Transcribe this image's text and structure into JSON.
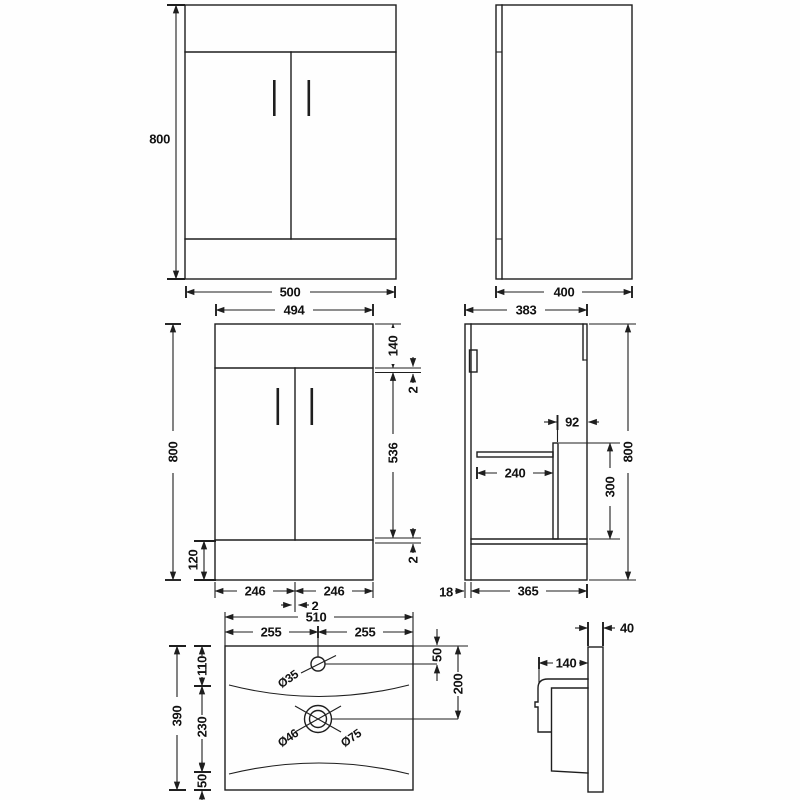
{
  "front_elevation": {
    "height": "800",
    "width": "500"
  },
  "side_elevation": {
    "depth": "400"
  },
  "front_detail": {
    "width": "494",
    "height": "800",
    "top_panel": "140",
    "top_gap": "2",
    "door_height": "536",
    "bottom_gap": "2",
    "plinth": "120",
    "left_door": "246",
    "right_door": "246",
    "center_gap": "2"
  },
  "side_detail": {
    "depth": "383",
    "height": "800",
    "back_offset": "92",
    "shelf_depth": "240",
    "shelf_height": "300",
    "panel_thickness": "18",
    "internal_depth": "365"
  },
  "basin_plan": {
    "width": "510",
    "left_half": "255",
    "right_half": "255",
    "depth": "390",
    "tap_zone": "110",
    "bowl_zone": "230",
    "front_edge": "50",
    "tap_inset": "50",
    "waste_inset": "200",
    "tap_hole_dia": "Ø35",
    "waste_inner_dia": "Ø46",
    "waste_outer_dia": "Ø75"
  },
  "basin_side": {
    "thickness": "40",
    "lip_depth": "140"
  }
}
